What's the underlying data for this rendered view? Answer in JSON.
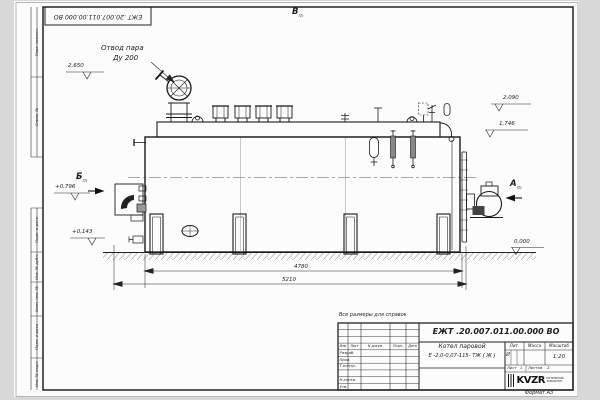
{
  "sheet": {
    "stamp_top": "ЕЖТ .20.007.011.00.000  ВО",
    "format_label": "Формат  А3",
    "margin_labels": {
      "perv_primen": "Перв. примен.",
      "sprav_no": "Справ. №",
      "podp_data_1": "Подп. и дата",
      "inv_dubl": "Инв. № дубл.",
      "vzam_inv": "Взам. инв. №",
      "podp_data_2": "Подп. и дата",
      "inv_podl": "Инв. № подл."
    }
  },
  "drawing": {
    "callout": {
      "line1": "Отвод пара",
      "line2": "Ду 200"
    },
    "views": {
      "top": {
        "label": "В",
        "ref": "(2)"
      },
      "front": {
        "label": "Б",
        "ref": "(2)"
      },
      "rear": {
        "label": "А",
        "ref": "(2)"
      }
    },
    "elevations": {
      "steam_valve_top": "2,650",
      "drum_top": "2,090",
      "casing_top": "1,746",
      "burner_axis": "+0,796",
      "manhole_axis": "+0,143",
      "ground": "0,000"
    },
    "dimensions": {
      "body_length": "4780",
      "overall_length": "5210"
    }
  },
  "title_block": {
    "note": "Все размеры для справок",
    "designation": "ЕЖТ .20.007.011.00.000  ВО",
    "name_line1": "Котел паровой",
    "name_line2": "Е -2,0-0,07-115- ТЖ ( Ж )",
    "columns": {
      "izm": "Изм",
      "list": "Лист",
      "doc": "N докум.",
      "podp": "Подп.",
      "data": "Дата"
    },
    "rows": {
      "razrab": "Разраб.",
      "prov": "Пров.",
      "tkontr": "Т.контр.",
      "nkontr": "Н.контр.",
      "utv": "Утв."
    },
    "lit_header": "Лит.",
    "mass_header": "Масса",
    "scale_header": "Масштаб",
    "lit_value": "И",
    "scale_value": "1:20",
    "sheet_label": "Лист",
    "sheet_no": "1",
    "sheets_label": "Листов",
    "sheets_total": "2",
    "logo": {
      "text": "KVZR",
      "sub1": "КОТЕЛЬНЫЙ",
      "sub2": "ЗАВОД РЭП"
    }
  }
}
